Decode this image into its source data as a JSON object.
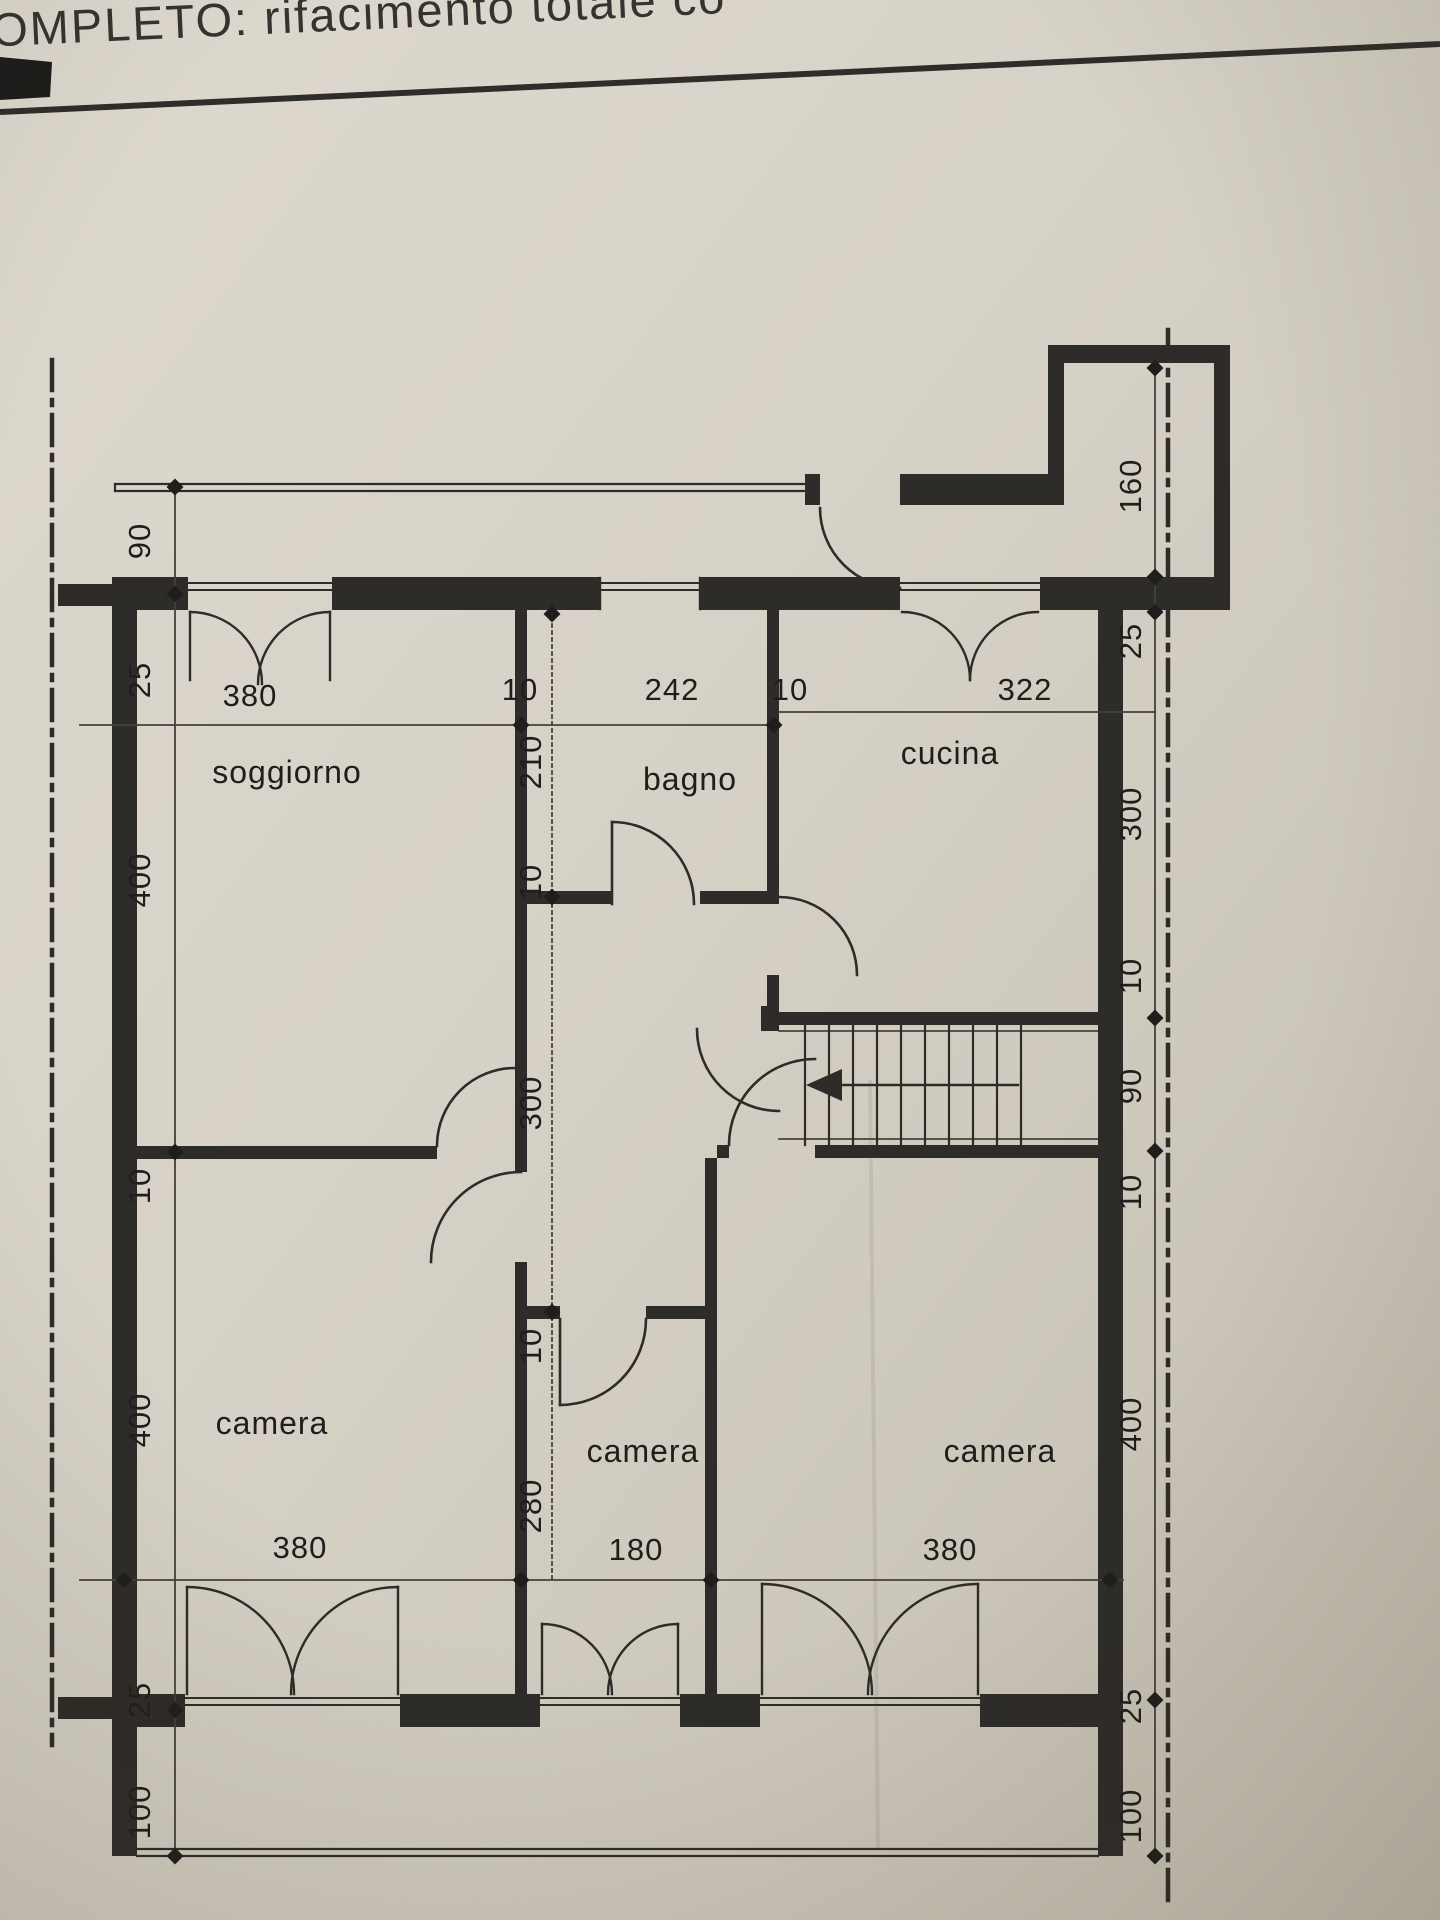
{
  "page": {
    "title_fragment": "OMPLETO: rifacimento totale co"
  },
  "plan": {
    "room_labels": [
      "soggiorno",
      "bagno",
      "cucina",
      "camera",
      "camera",
      "camera"
    ],
    "dims_top": [
      "380",
      "10",
      "242",
      "10"
    ],
    "dim_kitchen_width": "322",
    "dims_left": [
      "90",
      "25",
      "400",
      "10",
      "400",
      "25",
      "100"
    ],
    "dims_middle": [
      "210",
      "10",
      "300",
      "10",
      "280"
    ],
    "dims_right": [
      "160",
      "25",
      "300",
      "10",
      "90",
      "10",
      "400",
      "25",
      "100"
    ],
    "dims_bottom": [
      "380",
      "180",
      "380"
    ]
  },
  "colors": {
    "paper": "#d8d3c8",
    "ink": "#2e2c28",
    "dim_text": "#1f1e1c"
  }
}
